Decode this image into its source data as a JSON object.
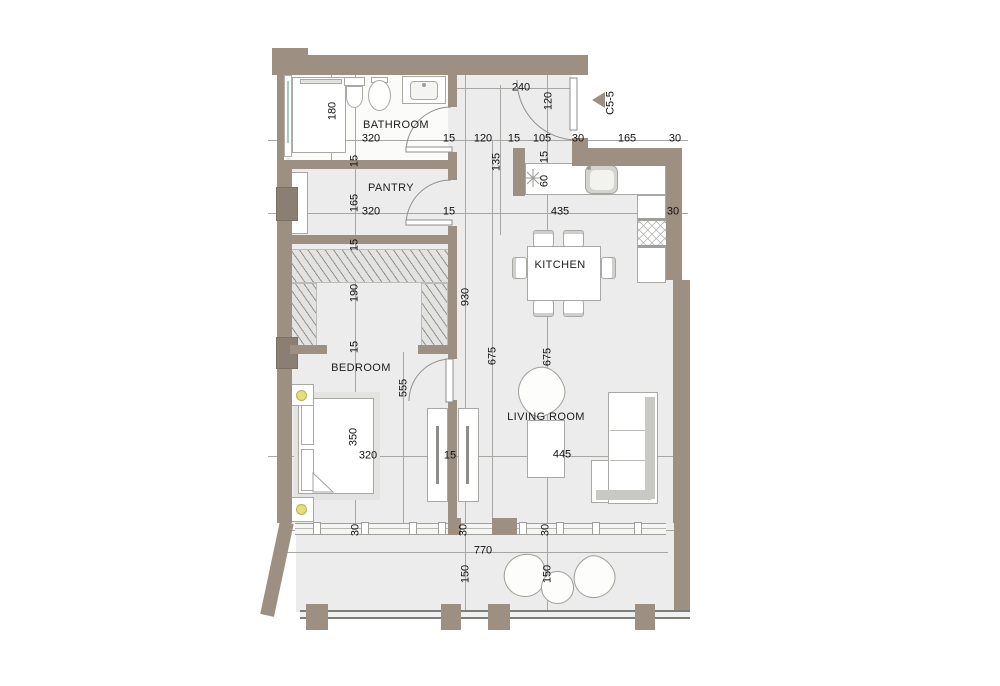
{
  "plan_title": "apartment floor plan",
  "rooms": {
    "bathroom": "BATHROOM",
    "pantry": "PANTRY",
    "kitchen": "KITCHEN",
    "bedroom": "BEDROOM",
    "living": "LIVING ROOM"
  },
  "marker": {
    "label": "C5-5"
  },
  "dims_h": [
    {
      "t": "240",
      "x": 521,
      "y": 88
    },
    {
      "t": "320",
      "x": 371,
      "y": 139
    },
    {
      "t": "15",
      "x": 449,
      "y": 139
    },
    {
      "t": "120",
      "x": 483,
      "y": 139
    },
    {
      "t": "15",
      "x": 514,
      "y": 139
    },
    {
      "t": "105",
      "x": 542,
      "y": 139
    },
    {
      "t": "30",
      "x": 578,
      "y": 139
    },
    {
      "t": "165",
      "x": 627,
      "y": 139
    },
    {
      "t": "30",
      "x": 675,
      "y": 139
    },
    {
      "t": "320",
      "x": 371,
      "y": 212
    },
    {
      "t": "15",
      "x": 449,
      "y": 212
    },
    {
      "t": "435",
      "x": 560,
      "y": 212
    },
    {
      "t": "30",
      "x": 673,
      "y": 212
    },
    {
      "t": "320",
      "x": 368,
      "y": 456
    },
    {
      "t": "15",
      "x": 450,
      "y": 456
    },
    {
      "t": "445",
      "x": 562,
      "y": 455
    },
    {
      "t": "770",
      "x": 483,
      "y": 551
    }
  ],
  "dims_v": [
    {
      "t": "120",
      "x": 549,
      "y": 101
    },
    {
      "t": "180",
      "x": 333,
      "y": 111
    },
    {
      "t": "135",
      "x": 497,
      "y": 162
    },
    {
      "t": "15",
      "x": 545,
      "y": 157
    },
    {
      "t": "60",
      "x": 545,
      "y": 181
    },
    {
      "t": "15",
      "x": 355,
      "y": 161
    },
    {
      "t": "165",
      "x": 355,
      "y": 203
    },
    {
      "t": "15",
      "x": 355,
      "y": 245
    },
    {
      "t": "190",
      "x": 355,
      "y": 293
    },
    {
      "t": "930",
      "x": 466,
      "y": 297
    },
    {
      "t": "15",
      "x": 355,
      "y": 347
    },
    {
      "t": "555",
      "x": 404,
      "y": 388
    },
    {
      "t": "675",
      "x": 493,
      "y": 356
    },
    {
      "t": "675",
      "x": 548,
      "y": 357
    },
    {
      "t": "350",
      "x": 354,
      "y": 437
    },
    {
      "t": "30",
      "x": 356,
      "y": 530
    },
    {
      "t": "30",
      "x": 464,
      "y": 530
    },
    {
      "t": "30",
      "x": 546,
      "y": 530
    },
    {
      "t": "150",
      "x": 466,
      "y": 574
    },
    {
      "t": "150",
      "x": 548,
      "y": 574
    }
  ],
  "colors": {
    "wall": "#9d8f82",
    "wall_column": "#8b7f73",
    "floor": "#ebeceb",
    "room_white": "#fbfbfa",
    "outline": "#a8a8a5",
    "dim_line": "#a7a7a4",
    "hatch_line": "#90908e",
    "lamp_yellow": "#e6df72",
    "glass_teal": "#a9c7c1",
    "text": "#111111"
  }
}
